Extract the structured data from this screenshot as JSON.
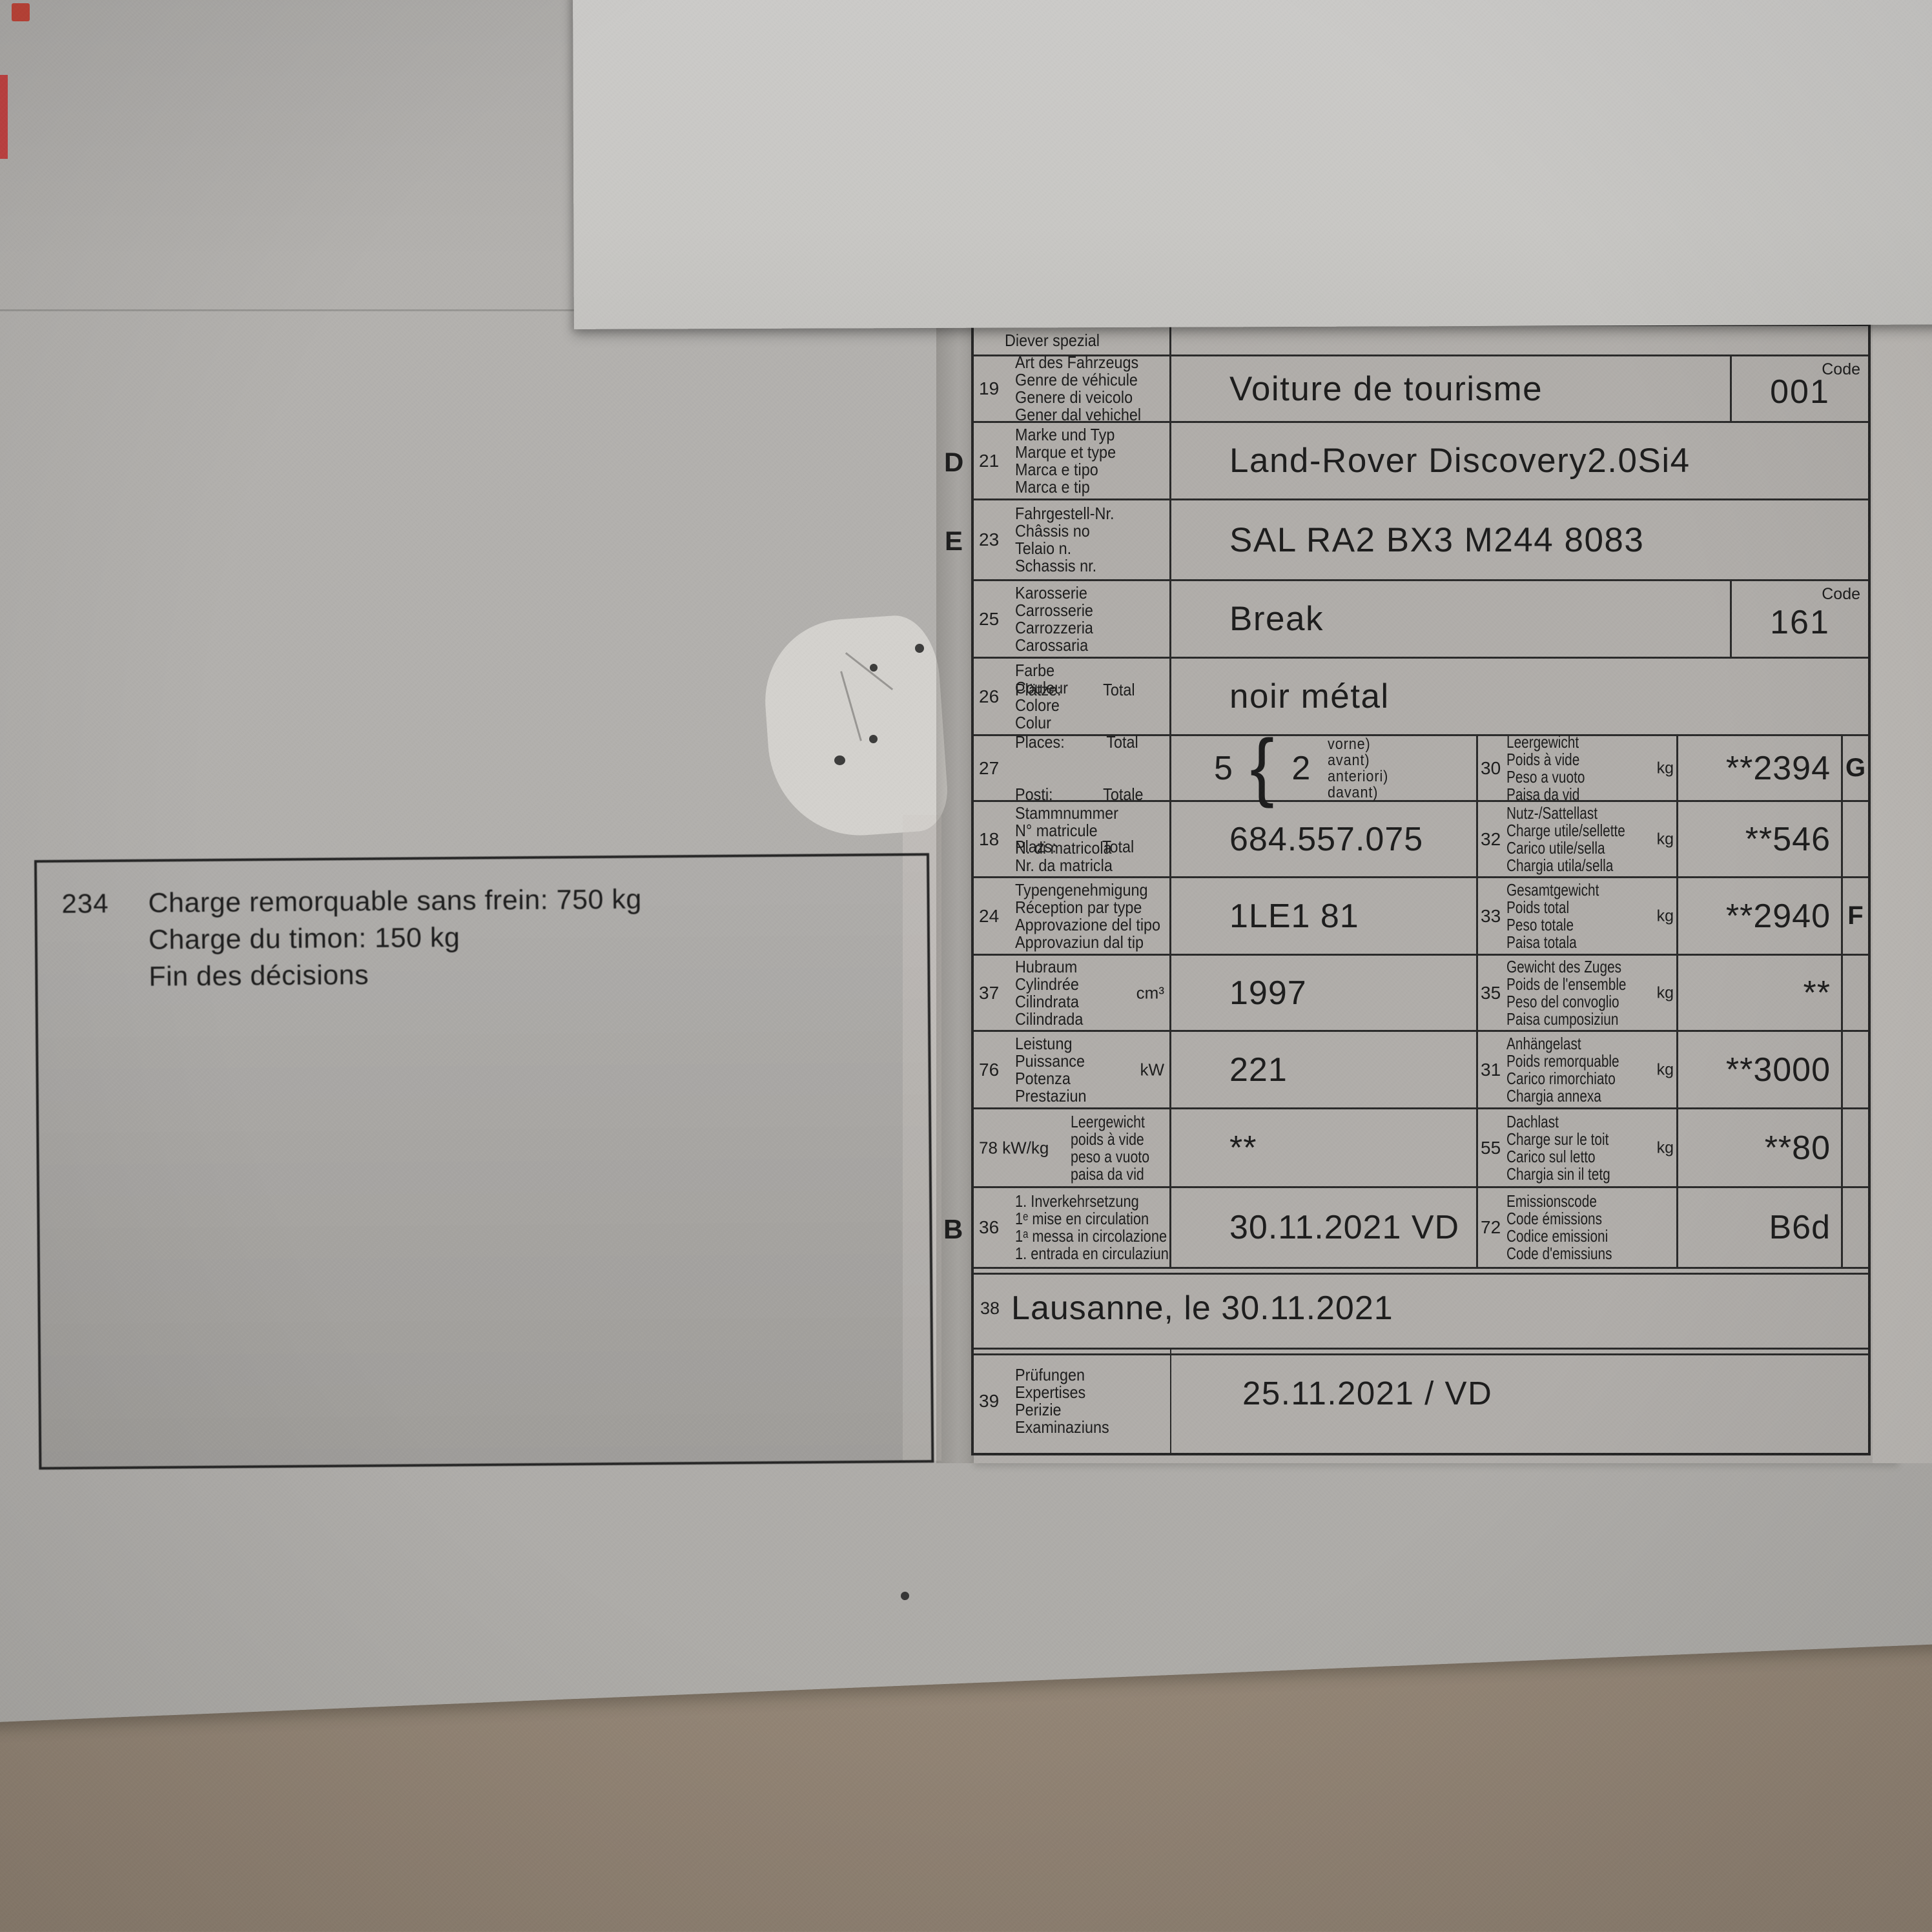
{
  "note": {
    "number": "234",
    "line1": "Charge remorquable sans frein: 750 kg",
    "line2": "Charge du timon: 150 kg",
    "line3": "Fin des décisions"
  },
  "permit": {
    "rows": [
      {
        "label": "Diever spezial"
      },
      {
        "num": "19",
        "labels": [
          "Art des Fahrzeugs",
          "Genre de véhicule",
          "Genere di veicolo",
          "Gener dal vehichel"
        ],
        "value": "Voiture de tourisme",
        "code_label": "Code",
        "code": "001"
      },
      {
        "margin": "D",
        "num": "21",
        "labels": [
          "Marke und Typ",
          "Marque et type",
          "Marca e tipo",
          "Marca e tip"
        ],
        "value": "Land-Rover Discovery2.0Si4"
      },
      {
        "margin": "E",
        "num": "23",
        "labels": [
          "Fahrgestell-Nr.",
          "Châssis no",
          "Telaio n.",
          "Schassis nr."
        ],
        "value": "SAL RA2 BX3 M244 8083"
      },
      {
        "num": "25",
        "labels": [
          "Karosserie",
          "Carrosserie",
          "Carrozzeria",
          "Carossaria"
        ],
        "value": "Break",
        "code_label": "Code",
        "code": "161"
      },
      {
        "num": "26",
        "labels": [
          "Farbe",
          "Couleur",
          "Colore",
          "Colur"
        ],
        "value": "noir métal"
      },
      {
        "num": "27",
        "labels": [
          "Plätze:          Total",
          "Places:          Total",
          "Posti:            Totale",
          "Plazs:           Total"
        ],
        "value_total": "5",
        "brace": "{",
        "value_front": "2",
        "front_labels": [
          "vorne)",
          "avant)",
          "anteriori)",
          "davant)"
        ],
        "right_num": "30",
        "right_labels": [
          "Leergewicht",
          "Poids à vide",
          "Peso a vuoto",
          "Paisa da vid"
        ],
        "unit": "kg",
        "right_value": "**2394",
        "letter": "G"
      },
      {
        "num": "18",
        "labels": [
          "Stammnummer",
          "N° matricule",
          "N. di matricola",
          "Nr. da matricla"
        ],
        "value": "684.557.075",
        "right_num": "32",
        "right_labels": [
          "Nutz-/Sattellast",
          "Charge utile/sellette",
          "Carico utile/sella",
          "Chargia utila/sella"
        ],
        "unit": "kg",
        "right_value": "**546"
      },
      {
        "num": "24",
        "labels": [
          "Typengenehmigung",
          "Réception par type",
          "Approvazione del tipo",
          "Approvaziun dal tip"
        ],
        "value": "1LE1 81",
        "right_num": "33",
        "right_labels": [
          "Gesamtgewicht",
          "Poids total",
          "Peso totale",
          "Paisa totala"
        ],
        "unit": "kg",
        "right_value": "**2940",
        "letter": "F"
      },
      {
        "num": "37",
        "labels": [
          "Hubraum",
          "Cylindrée",
          "Cilindrata",
          "Cilindrada"
        ],
        "unit_left": "cm³",
        "value": "1997",
        "right_num": "35",
        "right_labels": [
          "Gewicht des Zuges",
          "Poids de l'ensemble",
          "Peso del convoglio",
          "Paisa cumposiziun"
        ],
        "unit": "kg",
        "right_value": "**"
      },
      {
        "num": "76",
        "labels": [
          "Leistung",
          "Puissance",
          "Potenza",
          "Prestaziun"
        ],
        "unit_left": "kW",
        "value": "221",
        "right_num": "31",
        "right_labels": [
          "Anhängelast",
          "Poids remorquable",
          "Carico rimorchiato",
          "Chargia annexa"
        ],
        "unit": "kg",
        "right_value": "**3000"
      },
      {
        "num": "78 kW/kg",
        "labels": [
          "Leergewicht",
          "poids à vide",
          "peso a vuoto",
          "paisa da vid"
        ],
        "value": "**",
        "right_num": "55",
        "right_labels": [
          "Dachlast",
          "Charge sur le toit",
          "Carico sul letto",
          "Chargia sin il tetg"
        ],
        "unit": "kg",
        "right_value": "**80"
      },
      {
        "margin": "B",
        "num": "36",
        "labels": [
          "1. Inverkehrsetzung",
          "1ᵉ mise en circulation",
          "1ᵃ messa in circolazione",
          "1. entrada en circulaziun"
        ],
        "value": "30.11.2021 VD",
        "right_num": "72",
        "right_labels": [
          "Emissionscode",
          "Code émissions",
          "Codice emissioni",
          "Code d'emissiuns"
        ],
        "right_value": "B6d"
      },
      {
        "num": "38",
        "value": "Lausanne, le 30.11.2021"
      },
      {
        "num": "39",
        "labels": [
          "Prüfungen",
          "Expertises",
          "Perizie",
          "Examinaziuns"
        ],
        "value": "25.11.2021 / VD"
      }
    ]
  }
}
